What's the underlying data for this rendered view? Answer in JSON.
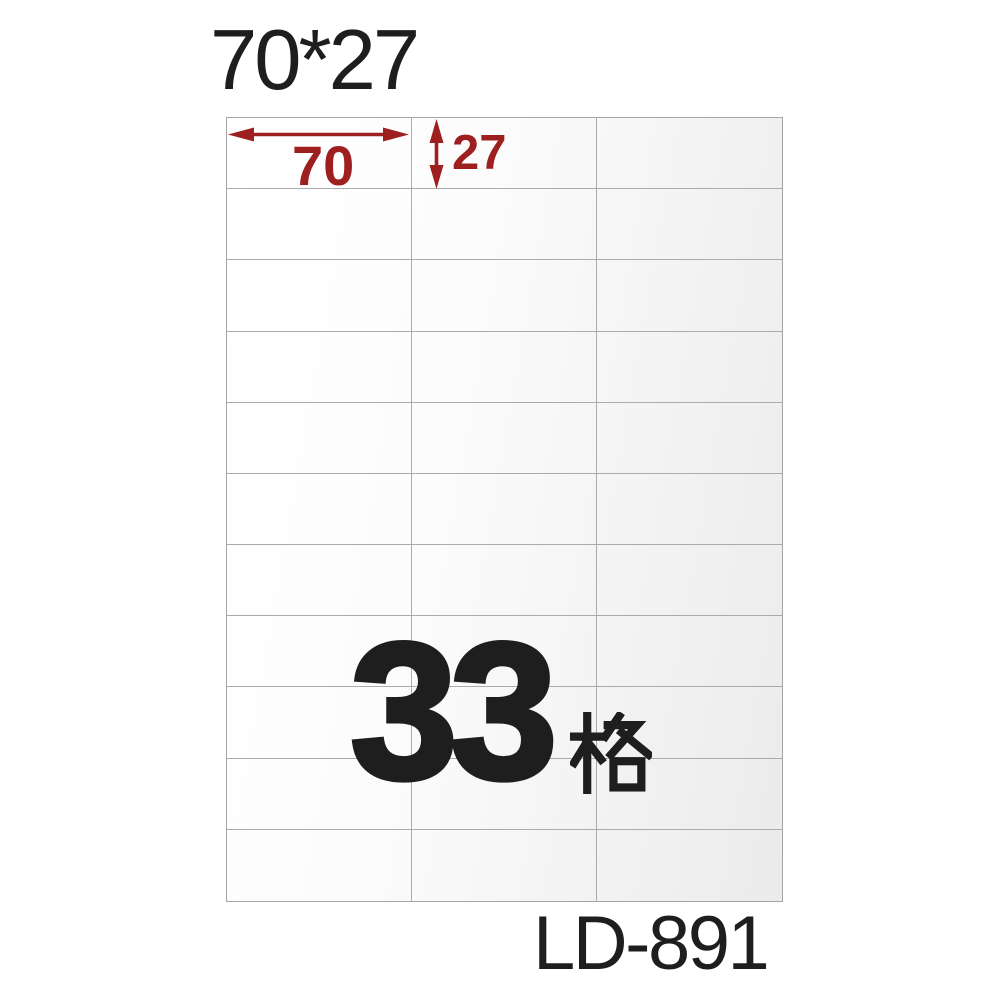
{
  "page": {
    "background_color": "#ffffff",
    "ink_color": "#1e1e1e",
    "accent_red": "#9e1f1f",
    "grid_line_color": "#ababab"
  },
  "header": {
    "size_label": "70*27"
  },
  "sheet": {
    "rows": 11,
    "columns": 3,
    "total_cells": 33,
    "background_from": "#ffffff",
    "background_to": "#ebebeb"
  },
  "dimensions": {
    "width_mm": "70",
    "height_mm": "27",
    "arrow_color": "#9e1f1f"
  },
  "center_label": {
    "full_text": "33格",
    "count": "33",
    "unit": "格"
  },
  "footer": {
    "model_code": "LD-891"
  }
}
